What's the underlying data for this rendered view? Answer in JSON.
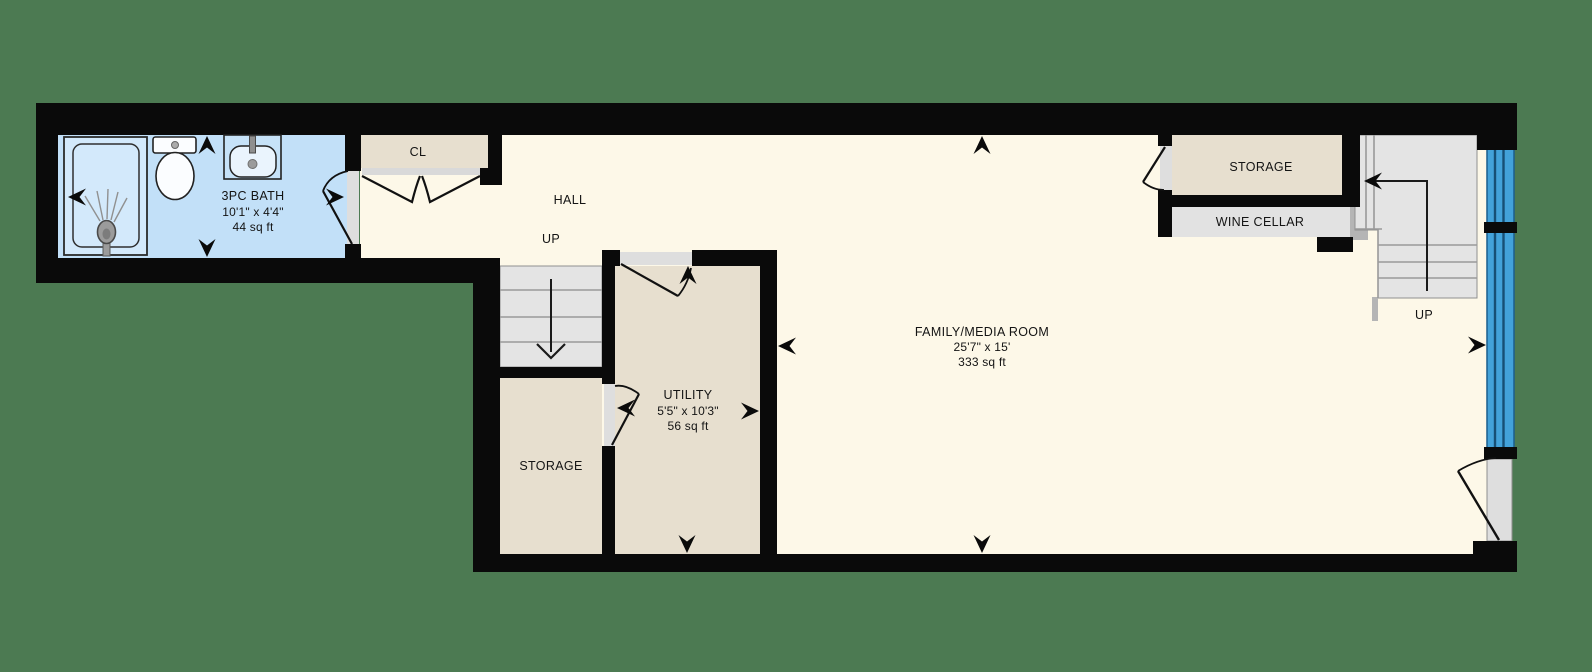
{
  "plan": {
    "bath": {
      "name": "3PC BATH",
      "dims": "10'1\" x 4'4\"",
      "area": "44 sq ft"
    },
    "closet": {
      "name": "CL"
    },
    "hall": {
      "name": "HALL",
      "stair_label": "UP"
    },
    "storage_left": {
      "name": "STORAGE"
    },
    "utility": {
      "name": "UTILITY",
      "dims": "5'5\" x 10'3\"",
      "area": "56 sq ft"
    },
    "family": {
      "name": "FAMILY/MEDIA ROOM",
      "dims": "25'7\" x 15'",
      "area": "333 sq ft"
    },
    "storage_right": {
      "name": "STORAGE"
    },
    "wine_cellar": {
      "name": "WINE CELLAR"
    },
    "stairs_right": {
      "stair_label": "UP"
    }
  },
  "colors": {
    "background": "#4C7A52",
    "wall": "#0A0A0A",
    "floor_cream": "#FDF8E8",
    "room_beige": "#E7DFCF",
    "bath_blue": "#C2E0F8",
    "window_blue": "#43A2DA",
    "stair_gray": "#E4E4E4",
    "door_gray": "#DEDEDE"
  }
}
